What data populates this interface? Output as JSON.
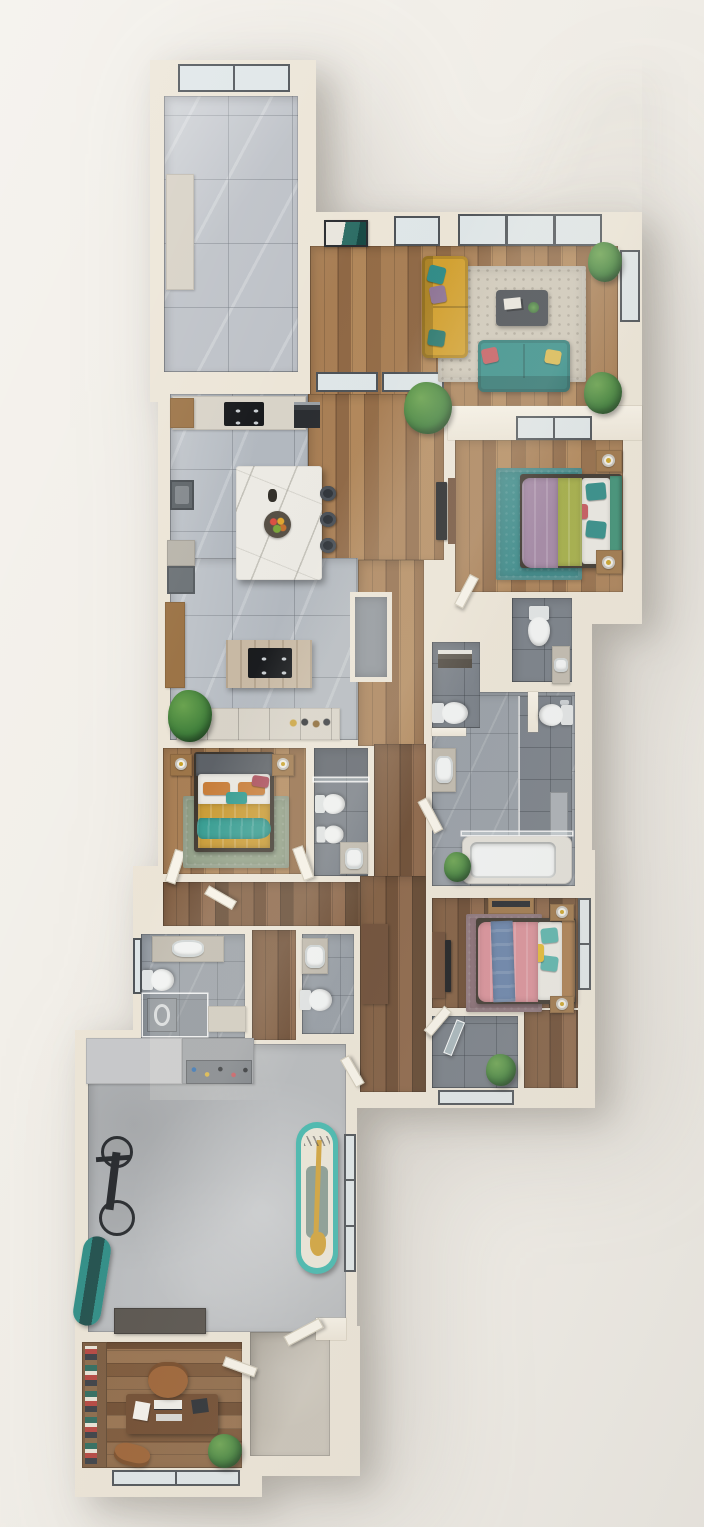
{
  "scene": {
    "title": "3D floor plan render, top-down view",
    "type": "architectural-floor-plan",
    "view": "top-down",
    "text_visible": "none"
  },
  "palette": {
    "background": "#f2efe9",
    "wall": "#ece5d7",
    "wall_hi": "#f7f2e7",
    "frame": "#4d5257",
    "glass": "#dfe6e8",
    "wood_living": "#a3794f",
    "wood_dark": "#7b573b",
    "wood_office": "#85603f",
    "tile_entry": "#bdc1c7",
    "tile_kitchen": "#b2b8bf",
    "tile_bath": "#969da5",
    "tile_bath_dark": "#757c85",
    "concrete": "#b7babd",
    "tile_beige": "#c2bbae",
    "island": "#eceae4",
    "travertine": "#c8b9a4",
    "sofa_yellow": "#d2a02e",
    "sofa_teal": "#2f8b86",
    "rug_living": "#cec7b8",
    "table_dark": "#3f444b",
    "bed_purple": "#a286a4",
    "bed_olive": "#a3ad46",
    "headboard_green": "#3c8f74",
    "rug_teal": "#3a8a8a",
    "red_pillow": "#c4565c",
    "purple_pillow": "#8f7596",
    "bed2_mustard": "#c9992f",
    "bed2_teal": "#2f9a8f",
    "bed2_headboard": "#5b6066",
    "rug_sage": "#93a289",
    "orange_pillow": "#c77b35",
    "maroon_pillow": "#a94a58",
    "bed3_pink": "#d88e97",
    "bed3_blue": "#6681a8",
    "bed3_teal": "#58b2aa",
    "bed3_yellow": "#e2b830",
    "rug_mauve": "#8d7078",
    "headboard_wood": "#a87a4c",
    "plant": "#3e7e3a",
    "plant_hi": "#6aa34f",
    "wood_furniture": "#9c7447",
    "desk_brown": "#6f4a2e",
    "chair_leather": "#9c6234",
    "board_teal": "#45b9ae",
    "paddle_yellow": "#d2a43c",
    "cab_light": "#c7c8ca",
    "cab_dark": "#9fa2a6",
    "fixture": "#f2f4f4",
    "gold": "#c9a227"
  },
  "rooms": [
    {
      "id": "foyer",
      "floor": "large gray marble tile",
      "items": [
        "entry cabinet",
        "picture window"
      ]
    },
    {
      "id": "living-room",
      "floor": "oak plank",
      "items": [
        "mustard sofa with teal and purple pillows",
        "teal loveseat with red and yellow pillows",
        "patterned area rug",
        "dark coffee table with books",
        "wall art",
        "three potted plants",
        "window wall"
      ]
    },
    {
      "id": "kitchen",
      "floor": "gray marble tile",
      "items": [
        "white marble island",
        "fruit bowl",
        "three bar stools",
        "black cooktop",
        "wall oven",
        "sink unit",
        "gray cabinets",
        "wood bar shelf",
        "grill prep island",
        "pantry nook",
        "lower counter run",
        "potted plant"
      ]
    },
    {
      "id": "hallway",
      "floor": "oak plank",
      "items": [
        "sliding glass doors",
        "large potted plant",
        "tv with console"
      ]
    },
    {
      "id": "master-bedroom",
      "floor": "oak plank",
      "items": [
        "bed with purple and olive blankets",
        "green headboard",
        "teal pillows",
        "teal rug",
        "two nightstands with lamps",
        "window"
      ]
    },
    {
      "id": "wc",
      "floor": "dark tile",
      "items": [
        "toilet",
        "small vanity with sink"
      ]
    },
    {
      "id": "guest-wc",
      "floor": "dark tile",
      "items": [
        "toilet",
        "towel shelf"
      ]
    },
    {
      "id": "master-bathroom",
      "floor": "stone tile",
      "items": [
        "vanity with sink",
        "walk-in shower with glass",
        "shower bench",
        "bathtub",
        "toilet nook",
        "potted plant"
      ]
    },
    {
      "id": "bedroom-2",
      "floor": "oak plank",
      "items": [
        "bed with mustard blanket and teal throw",
        "gray headboard",
        "orange and maroon pillows",
        "sage rug",
        "two nightstands with lamps"
      ]
    },
    {
      "id": "ensuite-bathroom",
      "floor": "dark tile",
      "items": [
        "walk-in shower",
        "toilet",
        "bidet",
        "vanity with sink"
      ]
    },
    {
      "id": "laundry-bathroom",
      "floor": "stone tile",
      "items": [
        "vanity with sink",
        "toilet",
        "washer in glass enclosure",
        "side counter",
        "window"
      ]
    },
    {
      "id": "hall-bathroom",
      "floor": "stone tile",
      "items": [
        "vanity with sink",
        "toilet",
        "tall wardrobe"
      ]
    },
    {
      "id": "bedroom-3",
      "floor": "walnut plank",
      "items": [
        "bed with pink blanket and blue throw",
        "wood headboard",
        "teal and yellow pillows",
        "mauve rug",
        "two nightstands with lamps",
        "dresser",
        "tv unit",
        "window"
      ]
    },
    {
      "id": "shower-bathroom",
      "floor": "dark tile",
      "items": [
        "glass shower door",
        "potted plant",
        "window"
      ]
    },
    {
      "id": "garage-gym",
      "floor": "polished concrete",
      "items": [
        "light storage cabinets",
        "dark cabinets with tool pegboard",
        "wall-mounted bicycle",
        "surfboard",
        "paddleboard with paddle",
        "workbench",
        "glazed side door"
      ]
    },
    {
      "id": "office",
      "floor": "walnut plank",
      "items": [
        "bookshelf wall",
        "executive desk",
        "monitor",
        "keyboard",
        "laptop",
        "papers",
        "leather desk chair",
        "guest chair",
        "potted plant",
        "window"
      ]
    },
    {
      "id": "entry-hall",
      "floor": "beige stone",
      "items": [
        "front door ajar",
        "office door ajar"
      ]
    }
  ]
}
